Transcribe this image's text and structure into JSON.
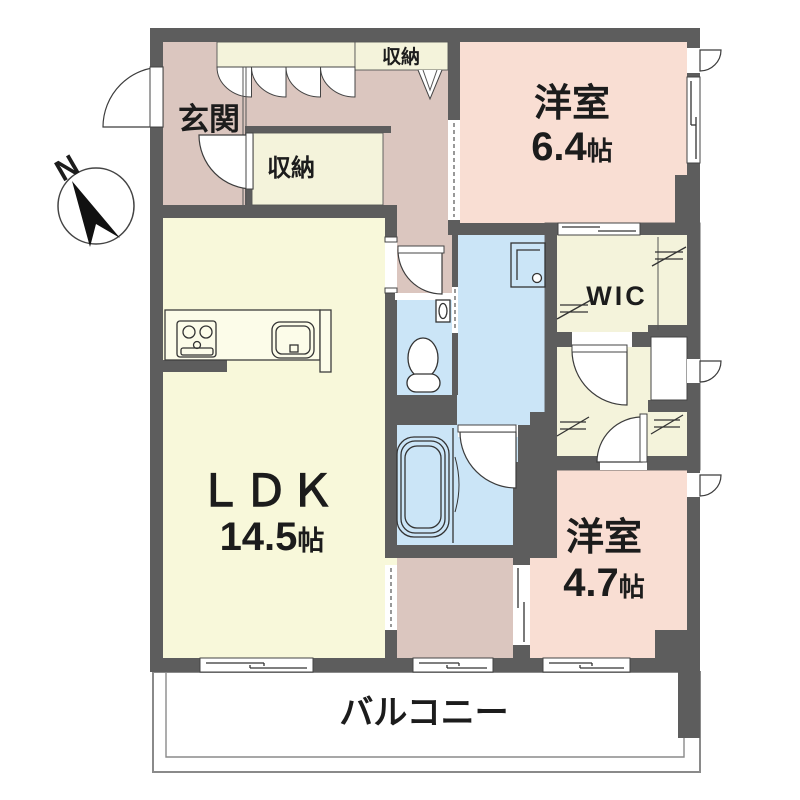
{
  "plan": {
    "compass_label": "N",
    "balcony_label": "バルコニー",
    "rooms": {
      "genkan": {
        "label": "玄関"
      },
      "closet_top": {
        "label": "収納"
      },
      "closet_hall": {
        "label": "収納"
      },
      "bedroom_64": {
        "label": "洋室",
        "size": "6.4",
        "unit": "帖"
      },
      "wic": {
        "label": "WIC"
      },
      "ldk": {
        "label": "ＬＤＫ",
        "size": "14.5",
        "unit": "帖"
      },
      "bedroom_47": {
        "label": "洋室",
        "size": "4.7",
        "unit": "帖"
      }
    }
  },
  "icons": [
    "compass-north-icon",
    "entry-door-swing-icon",
    "bifold-closet-door-icon",
    "v-fold-door-icon",
    "door-swing-icon",
    "sliding-door-icon",
    "pocket-door-icon",
    "window-icon",
    "kitchen-stove-icon",
    "kitchen-sink-icon",
    "toilet-icon",
    "hand-basin-icon",
    "washer-pan-icon",
    "bathtub-icon",
    "hanger-pipe-icon",
    "meter-box-door-icon"
  ],
  "colors": {
    "wall": "#5d5d5d",
    "hall": "#dbc6bf",
    "bedroom": "#f9ded3",
    "ldk": "#f8f8da",
    "closet": "#f4f3db",
    "wet": "#cbe5f7",
    "counter": "#fcfce9",
    "outline": "#3c3c3c",
    "balcony_border": "#8a8a8a"
  }
}
